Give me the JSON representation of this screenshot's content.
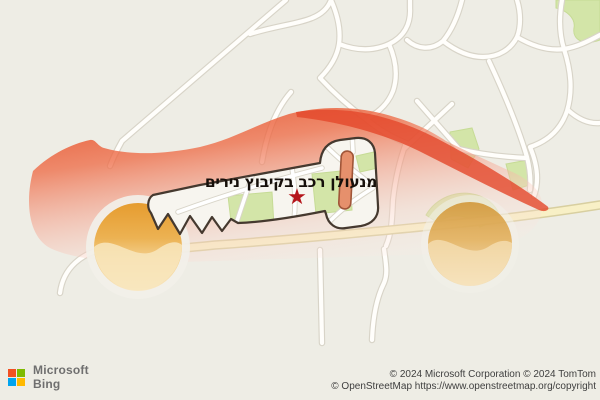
{
  "map": {
    "overlay_label": {
      "text": "מנעולן רכב בקיבוץ נירים",
      "direction": "rtl"
    },
    "marker": {
      "glyph": "★",
      "color": "#b5151b"
    },
    "theme": {
      "background": "#eeede5",
      "road_fill": "#fffefb",
      "road_casing": "#d8d4c8",
      "primary_road_fill": "#f8f0c6",
      "primary_road_casing": "#d8cfa0",
      "park_green": "#d3e5a8",
      "car_red": "#e64218",
      "wheel_orange": "#e69c2f",
      "key_fill": "#f7f5ef",
      "key_outline": "#45392f",
      "keyhole_fill": "#e6906c"
    }
  },
  "attribution": {
    "logo": {
      "company": "Microsoft",
      "product": "Bing",
      "square_colors": [
        "#f25022",
        "#7fba00",
        "#00a4ef",
        "#ffb900"
      ]
    },
    "line1": "© 2024 Microsoft Corporation © 2024 TomTom",
    "line2": "© OpenStreetMap https://www.openstreetmap.org/copyright"
  }
}
